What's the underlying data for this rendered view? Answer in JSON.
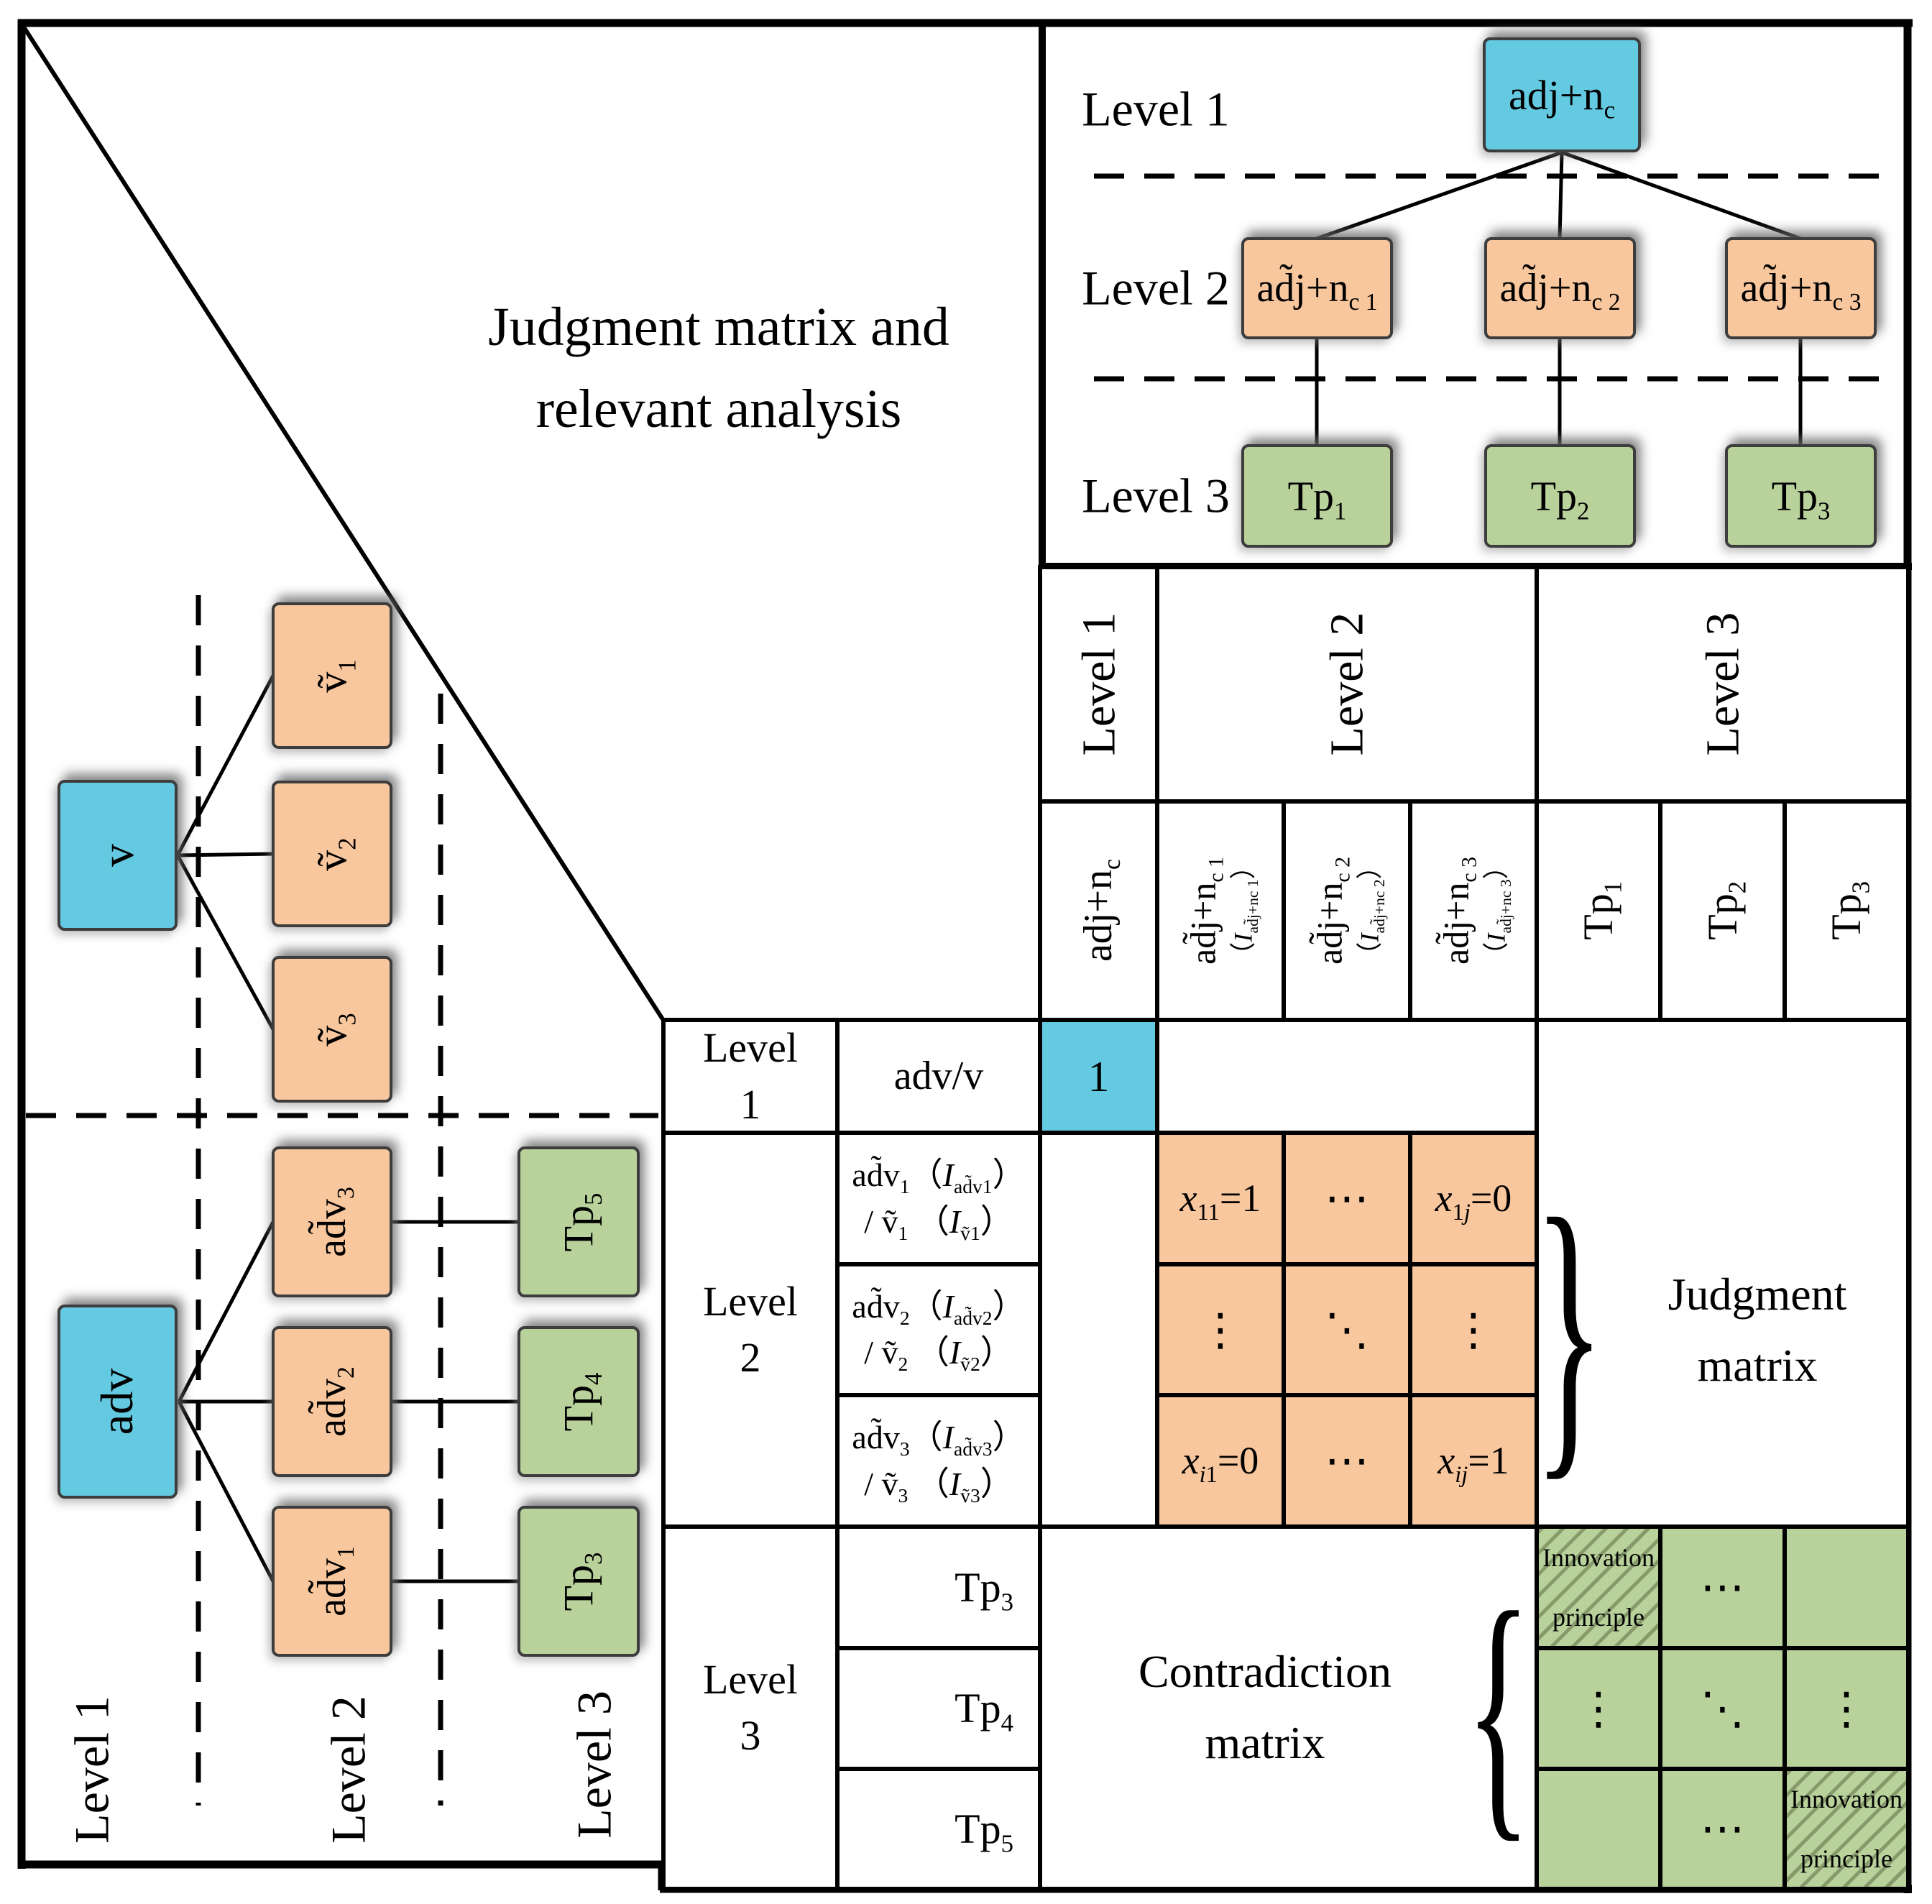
{
  "colors": {
    "level1_blue": "#63CAE1",
    "level2_orange": "#F9C79E",
    "level3_green": "#B9D29B",
    "line_black": "#000000"
  },
  "title": {
    "line1": "Judgment matrix and",
    "line2": "relevant analysis"
  },
  "top_tree": {
    "level1": "Level 1",
    "level2": "Level 2",
    "level3": "Level 3",
    "root": "adj+n<sub>c</sub>",
    "child1": "ad̃j+n<sub>c 1</sub>",
    "child2": "ad̃j+n<sub>c 2</sub>",
    "child3": "ad̃j+n<sub>c 3</sub>",
    "leaf1": "Tp<sub>1</sub>",
    "leaf2": "Tp<sub>2</sub>",
    "leaf3": "Tp<sub>3</sub>"
  },
  "left_tree": {
    "level1": "Level 1",
    "level2": "Level 2",
    "level3": "Level 3",
    "root_v": "v",
    "v1": "ṽ<sub>1</sub>",
    "v2": "ṽ<sub>2</sub>",
    "v3": "ṽ<sub>3</sub>",
    "root_adv": "adv",
    "adv1": "ad̃v<sub>1</sub>",
    "adv2": "ad̃v<sub>2</sub>",
    "adv3": "ad̃v<sub>3</sub>",
    "tp3": "Tp<sub>3</sub>",
    "tp4": "Tp<sub>4</sub>",
    "tp5": "Tp<sub>5</sub>"
  },
  "table": {
    "colgroup1": "Level 1",
    "colgroup2": "Level 2",
    "colgroup3": "Level 3",
    "col_adj": "adj+n<sub>c</sub>",
    "col_adj1": "ad̃j+n<sub>c 1</sub>",
    "col_adj1_note": "（<i>I</i><sub>ad̃j+nc 1</sub>）",
    "col_adj2": "ad̃j+n<sub>c 2</sub>",
    "col_adj2_note": "（<i>I</i><sub>ad̃j+nc 2</sub>）",
    "col_adj3": "ad̃j+n<sub>c 3</sub>",
    "col_adj3_note": "（<i>I</i><sub>ad̃j+nc 3</sub>）",
    "col_tp1": "Tp<sub>1</sub>",
    "col_tp2": "Tp<sub>2</sub>",
    "col_tp3": "Tp<sub>3</sub>",
    "rowgroup1": "Level 1",
    "rowgroup2": "Level 2",
    "rowgroup3": "Level 3",
    "row_advv": "adv/v",
    "row_adv1": "ad̃v<sub>1</sub>（<i>I</i><sub>ad̃v1</sub>）<br>/ ṽ<sub>1</sub> （<i>I</i><sub>ṽ1</sub>）",
    "row_adv2": "ad̃v<sub>2</sub>（<i>I</i><sub>ad̃v2</sub>）<br>/ ṽ<sub>2</sub> （<i>I</i><sub>ṽ2</sub>）",
    "row_adv3": "ad̃v<sub>3</sub>（<i>I</i><sub>ad̃v3</sub>）<br>/ ṽ<sub>3</sub> （<i>I</i><sub>ṽ3</sub>）",
    "row_tp3": "Tp<sub>3</sub>",
    "row_tp4": "Tp<sub>4</sub>",
    "row_tp5": "Tp<sub>5</sub>",
    "cell_one": "1",
    "j11": "<i>x</i><sub>11</sub>=1",
    "j12": "⋯",
    "j13": "<i>x</i><sub>1<i>j</i></sub>=0",
    "j21": "⋮",
    "j22": "⋱",
    "j23": "⋮",
    "j31": "<i>x</i><sub><i>i</i>1</sub>=0",
    "j32": "⋯",
    "j33": "<i>x</i><sub><i>ij</i></sub>=1",
    "judgment_label": "Judgment matrix",
    "contradiction_label": "Contradiction matrix",
    "innovation": "Innovation principle",
    "g12": "⋯",
    "g21": "⋮",
    "g22": "⋱",
    "g23": "⋮",
    "g32": "⋯",
    "brace_right": "}",
    "brace_left": "{"
  }
}
